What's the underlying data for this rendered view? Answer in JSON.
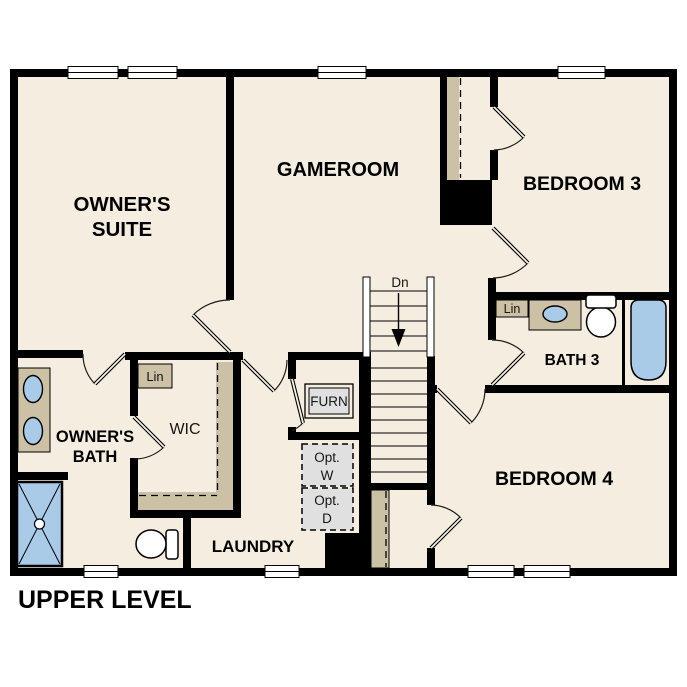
{
  "plan_title": "UPPER LEVEL",
  "rooms": {
    "owners_suite": {
      "line1": "OWNER'S",
      "line2": "SUITE"
    },
    "gameroom": "GAMEROOM",
    "bedroom3": "BEDROOM 3",
    "bedroom4": "BEDROOM 4",
    "bath3": "BATH 3",
    "owners_bath": {
      "line1": "OWNER'S",
      "line2": "BATH"
    },
    "wic": "WIC",
    "laundry": "LAUNDRY"
  },
  "annotations": {
    "stairs_direction": "Dn",
    "furnace": "FURN",
    "linen_wic": "Lin",
    "linen_bath3": "Lin",
    "optional_washer": {
      "line1": "Opt.",
      "line2": "W"
    },
    "optional_dryer": {
      "line1": "Opt.",
      "line2": "D"
    }
  },
  "colors": {
    "floor": "#f5eee0",
    "wall": "#000000",
    "tan": "#cdc1a5",
    "blue": "#a9cbe8",
    "gray": "#e0e0e0"
  }
}
